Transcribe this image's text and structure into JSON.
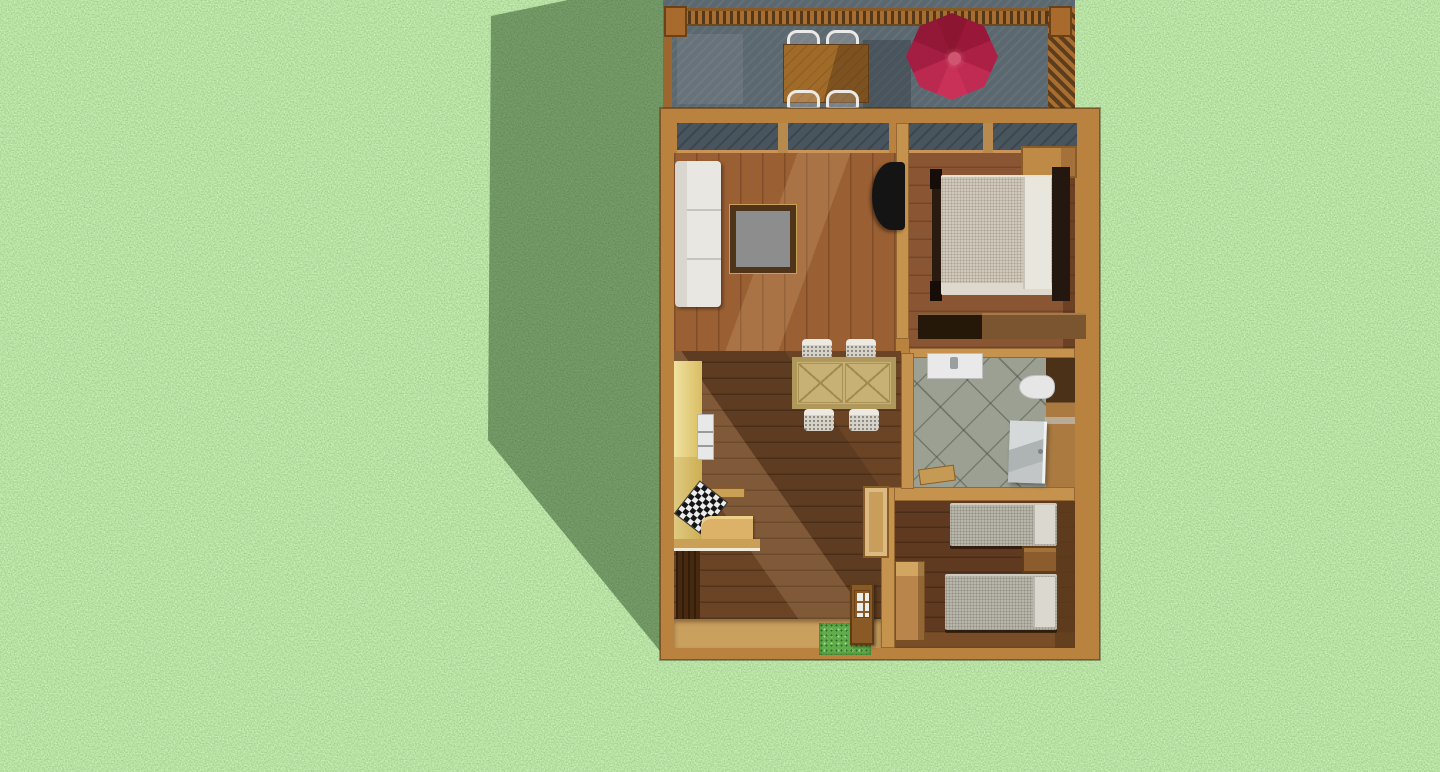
{
  "scene": {
    "type": "3d-render-top-view",
    "description": "Top-down 3D rendering of a furnished small house floor plan with attached wooden deck, set on a grass lawn with the building casting a shadow to the left",
    "environment": "grass lawn",
    "shadow_direction": "left"
  },
  "palette": {
    "grass_base": "#7CC05E",
    "grass_dark": "#2E6B2A",
    "grass_light": "#A8DD8A",
    "shadow": "rgba(14,48,12,0.42)",
    "deck_boards": "#5C6870",
    "railing_wood": "#A86D30",
    "umbrella_crimson": "#B02347",
    "house_wall_tan": "#B9823F",
    "interior_wall": "#C6934F",
    "living_floor": "#9A5F33",
    "dining_floor": "#6B4426",
    "bedroom_floor": "#8A5532",
    "kids_bedroom_floor": "#5F3A21",
    "bathroom_tile": "#9BA093",
    "entry_floor": "#C9A05E",
    "window_glass": "#49555E",
    "kitchen_cabinet": "#E8D189",
    "sofa_white": "#E9E7E1",
    "bedding_beige": "#CFC8BB",
    "bedding_gray": "#B8B5AB"
  },
  "deck": {
    "name": "rear deck",
    "furniture": [
      "patio table",
      "patio chair (x4)",
      "octagonal patio umbrella"
    ],
    "umbrella_color": "crimson red",
    "railing": "wood baluster railing"
  },
  "rooms": [
    {
      "name": "living room",
      "furniture": [
        "white sofa",
        "coffee table",
        "wall-mounted tv"
      ]
    },
    {
      "name": "kitchen / dining area",
      "furniture": [
        "cabinet run",
        "white appliance",
        "checkered cooktop",
        "counter",
        "trestle dining table",
        "dining chair (x4)"
      ]
    },
    {
      "name": "bedroom",
      "furniture": [
        "double bed with dark frame",
        "corner wardrobe",
        "long dresser bench"
      ]
    },
    {
      "name": "bathroom",
      "furniture": [
        "sink vanity",
        "toilet",
        "hinged door",
        "wood step"
      ]
    },
    {
      "name": "kids bedroom",
      "furniture": [
        "twin bed (x2)",
        "nightstand",
        "tall dresser"
      ]
    },
    {
      "name": "entry",
      "furniture": [
        "entry door with window panes",
        "grass doormat",
        "closet shelf",
        "dark closet cabinet"
      ]
    }
  ]
}
